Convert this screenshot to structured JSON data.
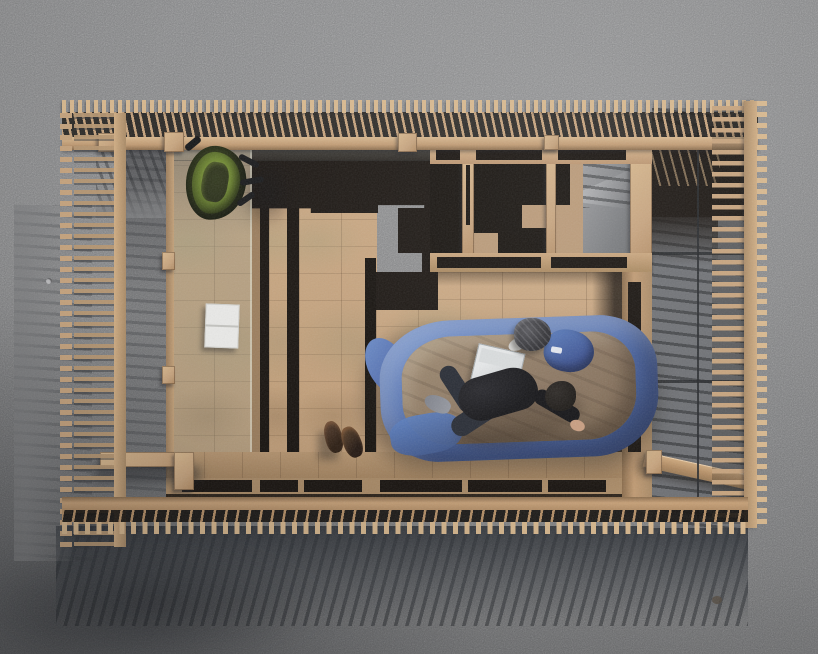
{
  "scene": {
    "title": "Aerial top-down photograph of a slatted timber pavilion on a concrete lot; a person rests in an opened blue sleeping bag on the wooden floor",
    "setting": "afternoon light from the upper right casting long comb-like slat shadows toward the lower left",
    "structure": {
      "north_edge": "row of thin vertical timber slats with rail",
      "west_edge": "ladder-like slat screen",
      "east_edge": "horizontal slat screen with long shadows",
      "south_edge": "slat comb casting long diagonal shadows",
      "interior": "parquet timber floor, hollow plan-cut walls, glazed corridor strip, stepped shadow of a stair, concrete courtyard patch"
    },
    "objects": [
      {
        "name": "backpack",
        "description": "green and black backpack by the north rail"
      },
      {
        "name": "white-book",
        "description": "white open book on the glazed corridor floor"
      },
      {
        "name": "boots",
        "description": "pair of dark leather boots beside the sleeping area"
      },
      {
        "name": "sleeping-bag",
        "description": "blue sleeping bag opened flat with tan lining"
      },
      {
        "name": "person",
        "description": "person in black sweater, dark trousers and grey socks lying curled on one side"
      },
      {
        "name": "laptop",
        "description": "light grey laptop lying open on the sleeping bag"
      },
      {
        "name": "beanie",
        "description": "dark marled beanie with white trim above the bag"
      },
      {
        "name": "bag-logo",
        "description": "small unreadable white brand mark on the blue hood"
      }
    ]
  },
  "colors": {
    "concrete": "#7d7e80",
    "concrete_light": "#8f9092",
    "concrete_dark": "#64676b",
    "wood": "#c6a37d",
    "wood_light": "#d8b88e",
    "wood_mid": "#b08a62",
    "wood_dark": "#8d7050",
    "cavity": "#17120e",
    "shadow_black": "#1a1511",
    "bag_blue": "#5b7fc0",
    "bag_blue_dark": "#41589b",
    "bag_lining": "#947d66",
    "pack_green": "#7f9a3a",
    "cloth_black": "#17171a",
    "pants_navy": "#262a33",
    "sock_grey": "#94979f",
    "skin": "#c79d80",
    "boot_brown": "#45311f",
    "paper_white": "#e9e9e7",
    "laptop_grey": "#d4d7d8",
    "hat_charcoal": "#3a3a3e"
  }
}
